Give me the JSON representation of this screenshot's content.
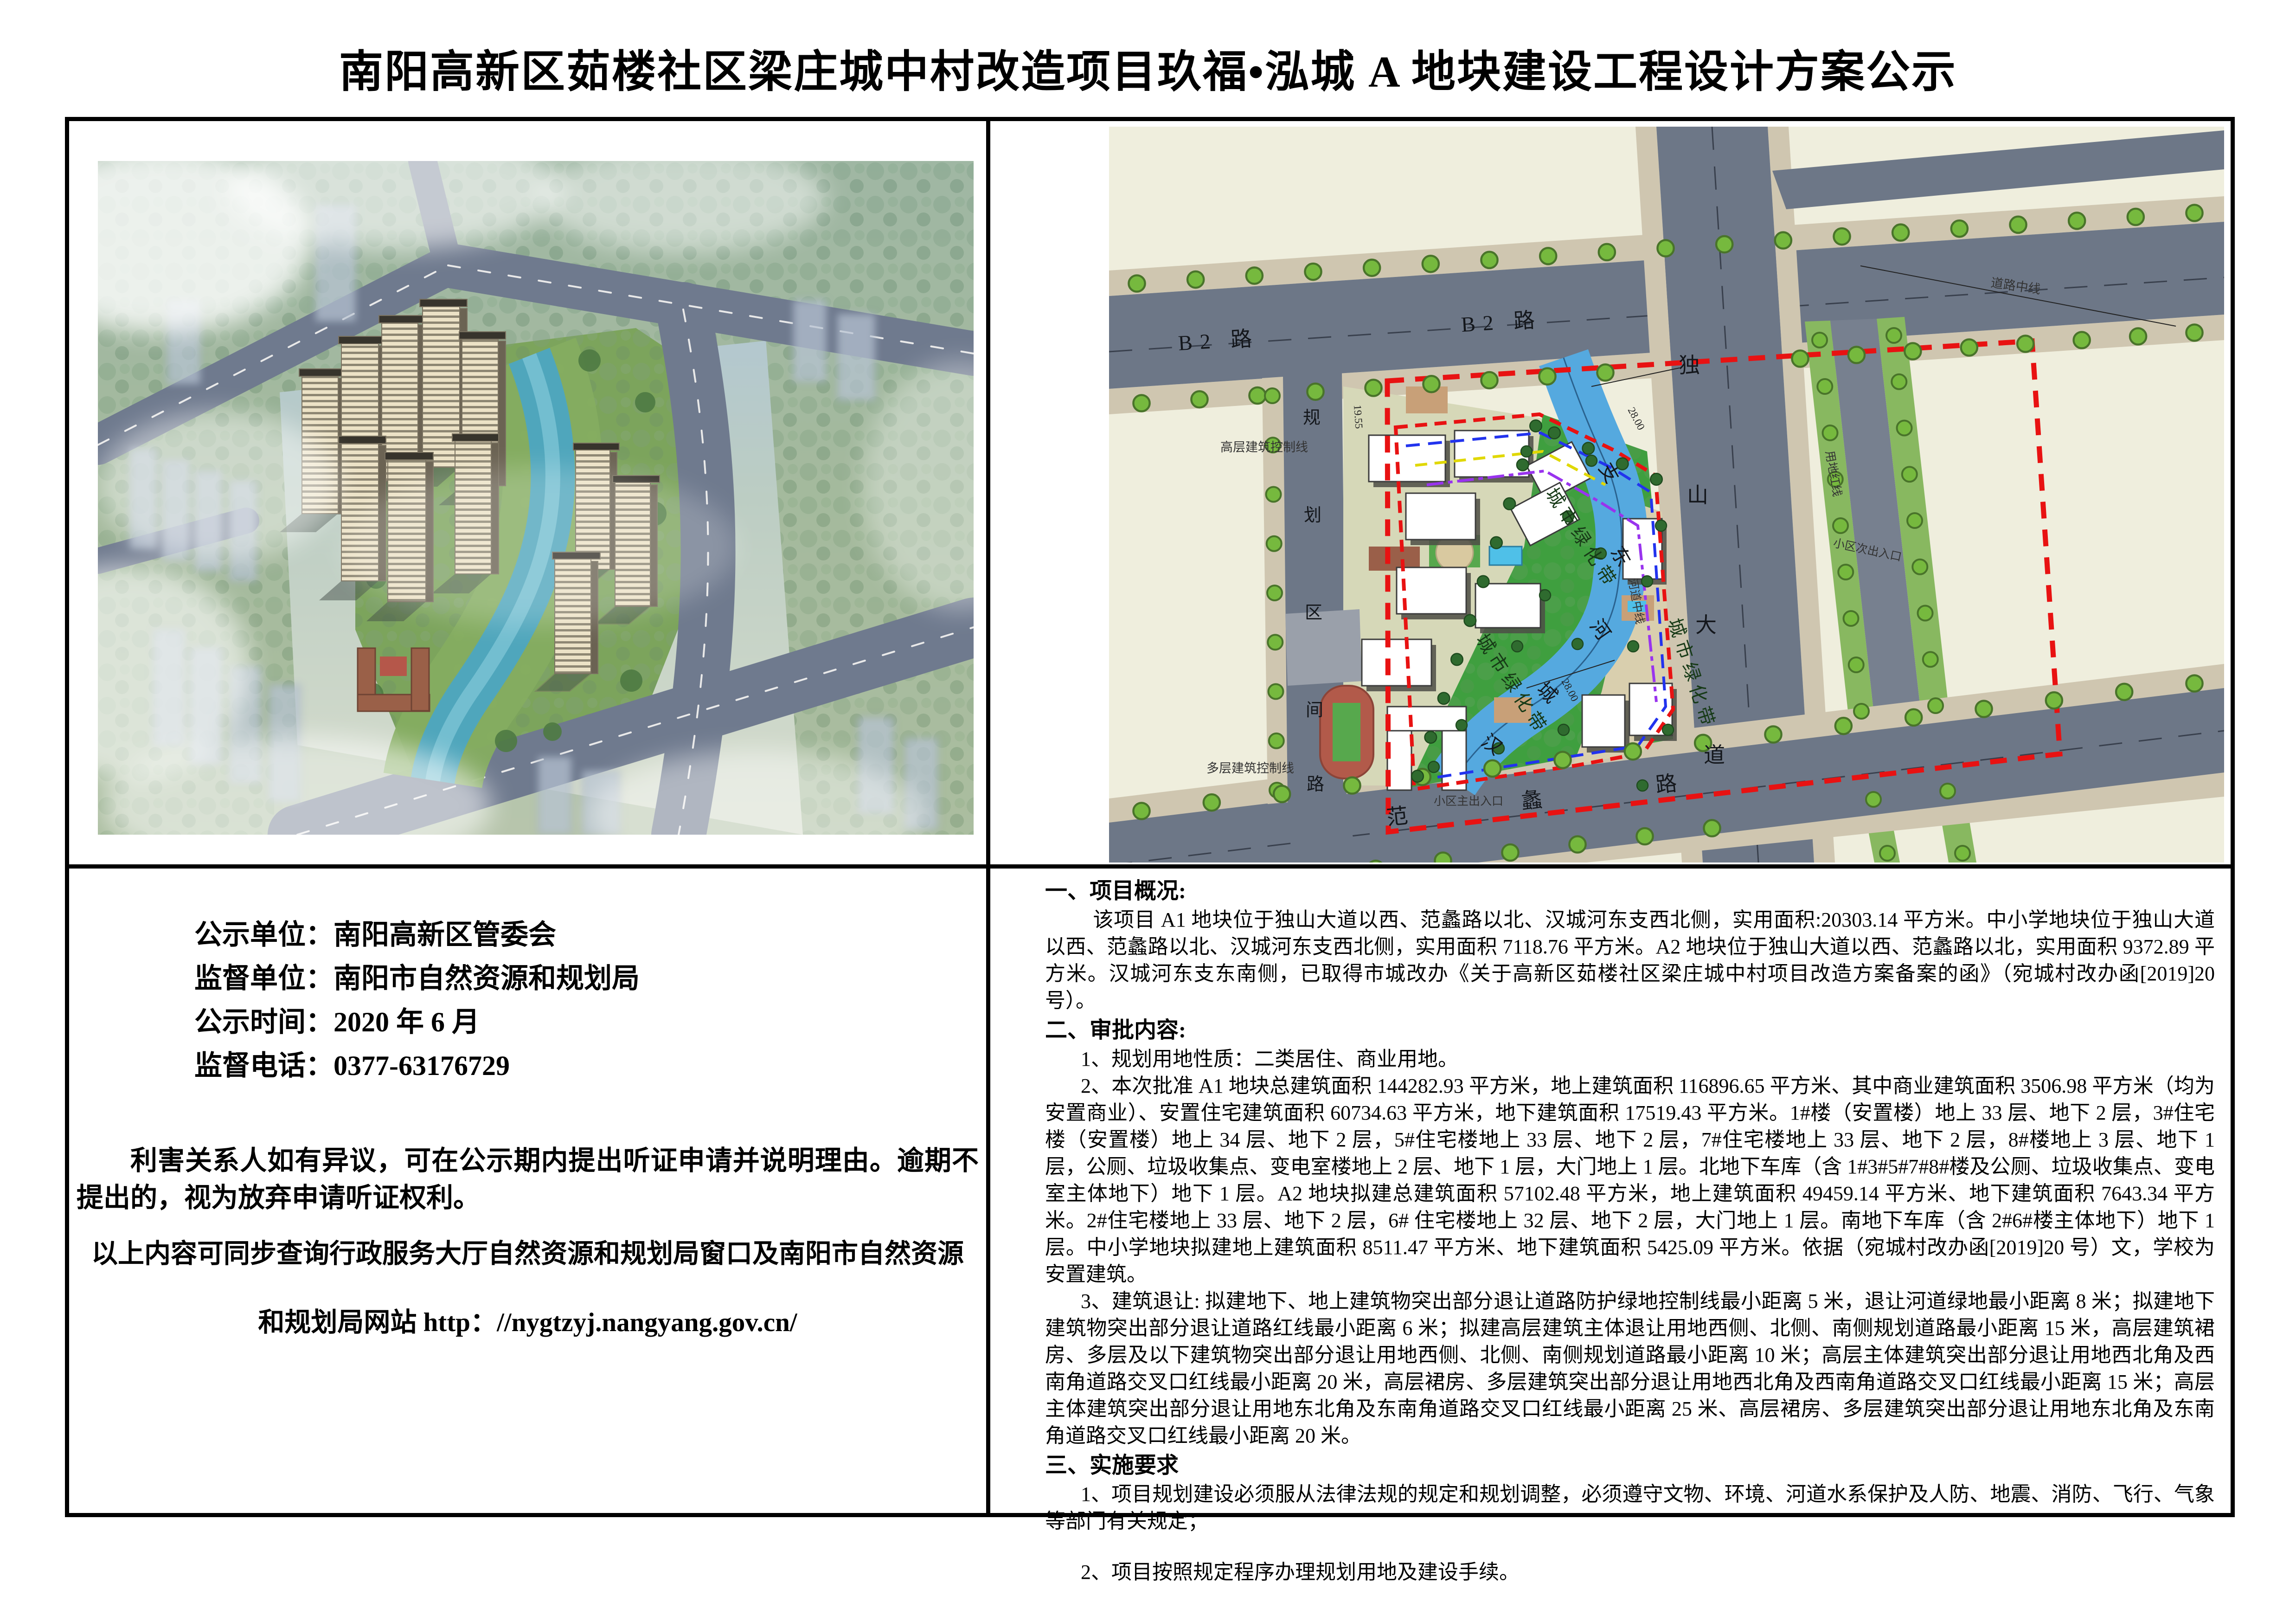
{
  "page": {
    "title": "南阳高新区茹楼社区梁庄城中村改造项目玖福•泓城 A 地块建设工程设计方案公示"
  },
  "info_panel": {
    "fields": [
      {
        "label": "公示单位：",
        "value": "南阳高新区管委会"
      },
      {
        "label": "监督单位：",
        "value": "南阳市自然资源和规划局"
      },
      {
        "label": "公示时间：",
        "value": "2020 年 6 月"
      },
      {
        "label": "监督电话：",
        "value": "0377-63176729"
      }
    ],
    "notice_objection": "利害关系人如有异议，可在公示期内提出听证申请并说明理由。逾期不提出的，视为放弃申请听证权利。",
    "notice_query": "以上内容可同步查询行政服务大厅自然资源和规划局窗口及南阳市自然资源",
    "notice_site": "和规划局网站 http：//nygtzyj.nangyang.gov.cn/"
  },
  "details": {
    "section1_title": "一、项目概况:",
    "section1_para": "该项目 A1 地块位于独山大道以西、范蠡路以北、汉城河东支西北侧，实用面积:20303.14 平方米。中小学地块位于独山大道以西、范蠡路以北、汉城河东支西北侧，实用面积 7118.76 平方米。A2 地块位于独山大道以西、范蠡路以北，实用面积 9372.89 平方米。汉城河东支东南侧，已取得市城改办《关于高新区茹楼社区梁庄城中村项目改造方案备案的函》（宛城村改办函[2019]20 号）。",
    "section2_title": "二、审批内容:",
    "item1": "1、规划用地性质：二类居住、商业用地。",
    "item2": "2、本次批准 A1 地块总建筑面积 144282.93 平方米，地上建筑面积 116896.65 平方米、其中商业建筑面积 3506.98 平方米（均为安置商业）、安置住宅建筑面积 60734.63 平方米，地下建筑面积 17519.43 平方米。1#楼（安置楼）地上 33 层、地下 2 层，3#住宅楼（安置楼）地上 34 层、地下 2 层，5#住宅楼地上 33 层、地下 2 层，7#住宅楼地上 33 层、地下 2 层，8#楼地上 3 层、地下 1 层，公厕、垃圾收集点、变电室楼地上 2 层、地下 1 层，大门地上 1 层。北地下车库（含 1#3#5#7#8#楼及公厕、垃圾收集点、变电室主体地下）地下 1 层。A2 地块拟建总建筑面积 57102.48 平方米，地上建筑面积 49459.14 平方米、地下建筑面积 7643.34 平方米。2#住宅楼地上 33 层、地下 2 层，6# 住宅楼地上 32 层、地下 2 层，大门地上 1 层。南地下车库（含 2#6#楼主体地下）地下 1 层。中小学地块拟建地上建筑面积 8511.47 平方米、地下建筑面积 5425.09 平方米。依据（宛城村改办函[2019]20 号）文，学校为安置建筑。",
    "item3": "3、建筑退让: 拟建地下、地上建筑物突出部分退让道路防护绿地控制线最小距离 5 米，退让河道绿地最小距离 8 米；拟建地下建筑物突出部分退让道路红线最小距离 6 米；拟建高层建筑主体退让用地西侧、北侧、南侧规划道路最小距离 15 米，高层建筑裙房、多层及以下建筑物突出部分退让用地西侧、北侧、南侧规划道路最小距离 10 米；高层主体建筑突出部分退让用地西北角及西南角道路交叉口红线最小距离 20 米，高层裙房、多层建筑突出部分退让用地西北角及西南角道路交叉口红线最小距离 15 米；高层主体建筑突出部分退让用地东北角及东南角道路交叉口红线最小距离 25 米、高层裙房、多层建筑突出部分退让用地东北角及东南角道路交叉口红线最小距离 20 米。",
    "section3_title": "三、实施要求",
    "req1": "1、项目规划建设必须服从法律法规的规定和规划调整，必须遵守文物、环境、河道水系保护及人防、地震、消防、飞行、气象等部门有关规定；",
    "req2": "2、项目按照规定程序办理规划用地及建设手续。"
  },
  "site_plan": {
    "labels": {
      "b2_left": "B2  路",
      "b2_mid": "B2  路",
      "dushan": [
        "独",
        "山",
        "大",
        "道"
      ],
      "guihua": [
        "规",
        "划",
        "区",
        "间",
        "路"
      ],
      "fanli": [
        "范",
        "蠡",
        "路"
      ],
      "river": [
        "汉",
        "城",
        "河",
        "东",
        "支"
      ],
      "belt1": "城市绿化带",
      "belt2": "城市绿化带",
      "belt3": "城市绿化带",
      "road_center": "道路中线",
      "river_center": "河道中线",
      "redline": "用地红线",
      "ctrl_high": "高层建筑控制线",
      "ctrl_multi": "多层建筑控制线",
      "entrance_main": "小区主出入口",
      "entrance_sec": "小区次出入口",
      "dim_1955": "19.55",
      "dim_28a": "28.00",
      "dim_28b": "28.00"
    },
    "colors": {
      "boundary_red": "#e81212",
      "ctrl_blue": "#2233ee",
      "ctrl_yellow": "#e0d800",
      "ctrl_purple": "#9933ee",
      "river_blue": "#55a9df",
      "belt_green": "#3f9f3f",
      "road_grey": "#6d7787",
      "sidewalk_tan": "#cfc6b0"
    }
  }
}
